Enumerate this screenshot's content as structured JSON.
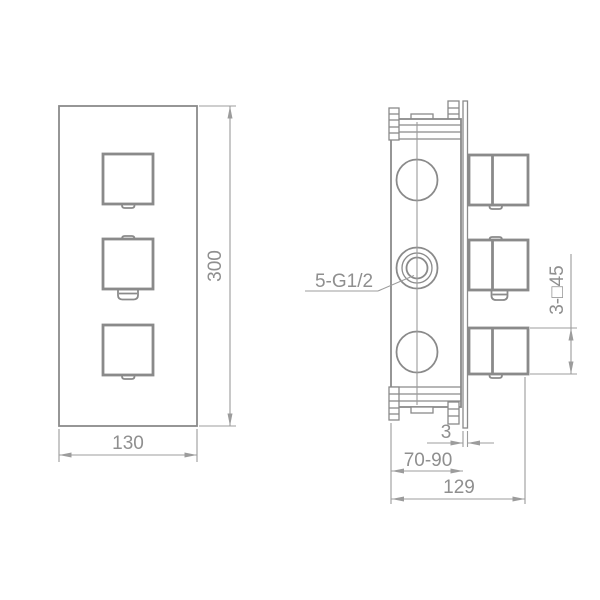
{
  "drawing": {
    "description": "Technical dimension drawing of concealed thermostatic shower valve, front and side views",
    "front_view": {
      "height": "300",
      "width": "130"
    },
    "side_view": {
      "port": "5-G1/2",
      "handle_square": "3-□45",
      "wall_flange_thickness": "3",
      "install_depth": "70-90",
      "total_depth": "129"
    },
    "colors": {
      "outline": "#8a8a8a",
      "dimension": "#9c9c9c",
      "text": "#8f8f8f",
      "background": "#ffffff"
    }
  }
}
